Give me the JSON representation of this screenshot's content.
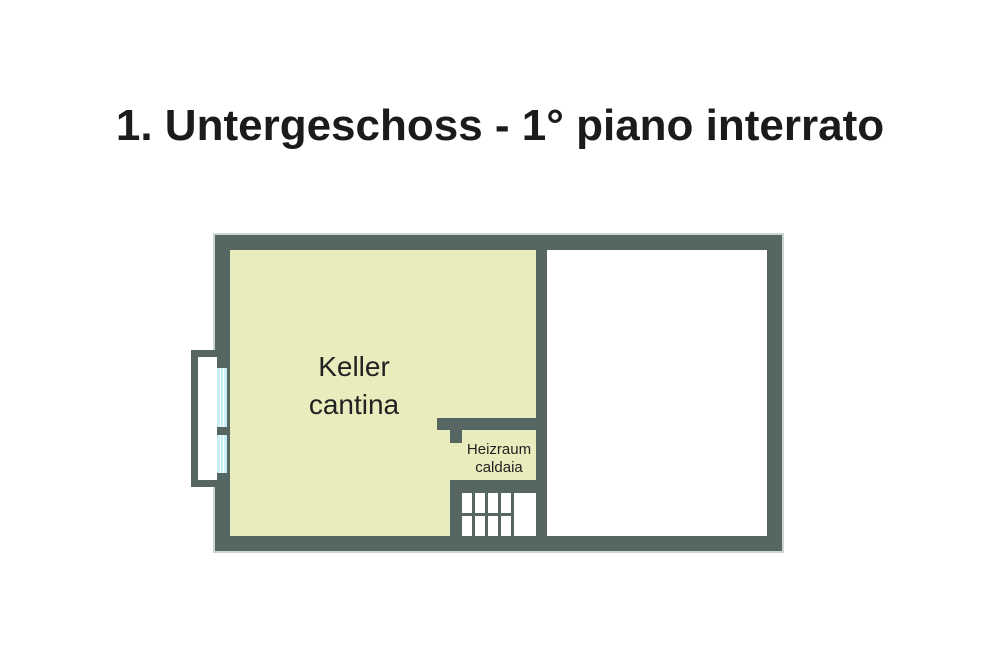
{
  "title": "1. Untergeschoss - 1° piano interrato",
  "colors": {
    "wall": "#566663",
    "room": "#e9ecbc",
    "glass": "#c9edf4",
    "bg": "#ffffff",
    "outline": "#cdd5d3",
    "text": "#1b1b1b"
  },
  "rooms": {
    "keller": {
      "label_de": "Keller",
      "label_it": "cantina"
    },
    "heizraum": {
      "label_de": "Heizraum",
      "label_it": "caldaia"
    }
  }
}
